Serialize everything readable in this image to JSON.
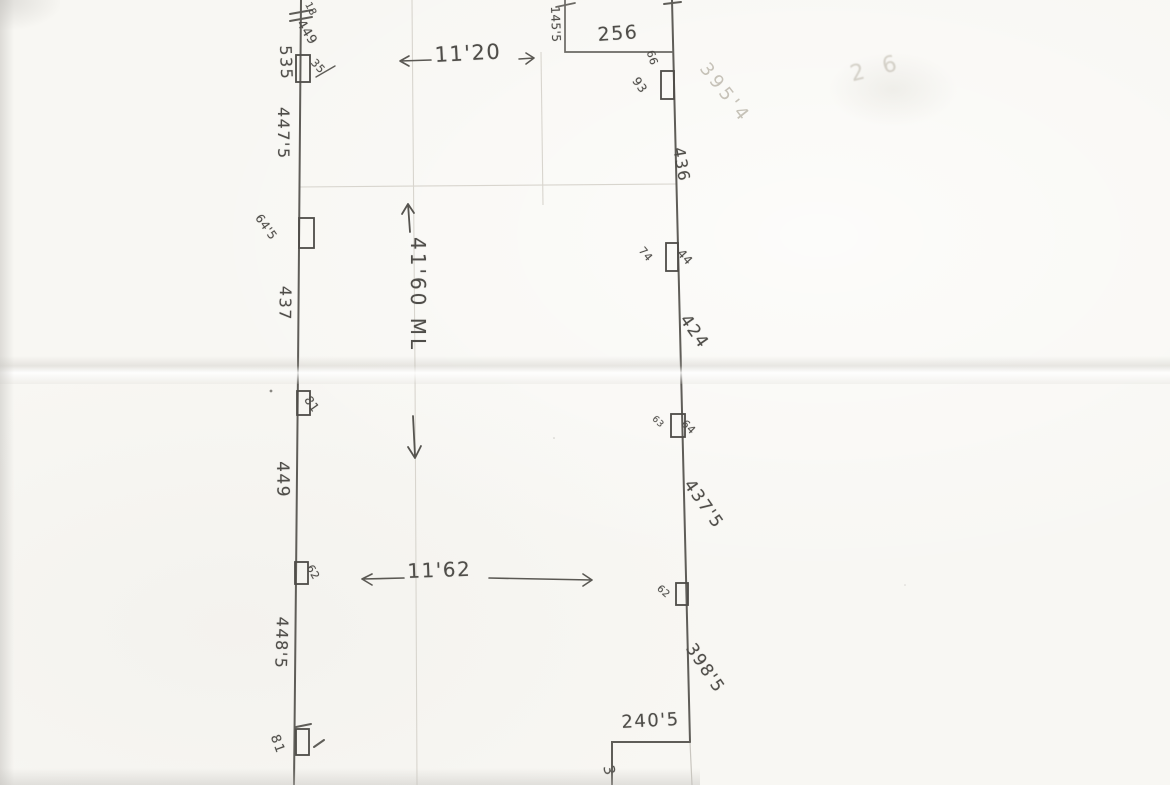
{
  "dimensions": {
    "top": "11'20",
    "vertical": "41'60 ML",
    "lower": "11'62"
  },
  "top_step": {
    "side": "145'5",
    "width": "256"
  },
  "bottom_step": {
    "width": "240'5",
    "cut_digit": "3"
  },
  "left_wall": {
    "break_note_small": "18",
    "break_note": "449",
    "win1_label": "535",
    "win1_note": "35",
    "seg1": "447'5",
    "win2_label": "64'5",
    "seg2": "437",
    "win3_label": "81",
    "seg3": "449",
    "win4_label": "62",
    "seg4": "448'5",
    "win5_label": "81"
  },
  "right_wall": {
    "faint_area_note": "395'4",
    "win1_label_top": "66",
    "win1_label_bottom": "93",
    "seg1": "436",
    "win2_label_left": "74",
    "win2_label_right": "44",
    "seg2": "424",
    "win3_label_left": "63",
    "win3_label_right": "64",
    "seg3": "437'5",
    "win4_label": "62",
    "seg4": "398'5"
  },
  "ghost": {
    "bleed_note": "2 6"
  }
}
